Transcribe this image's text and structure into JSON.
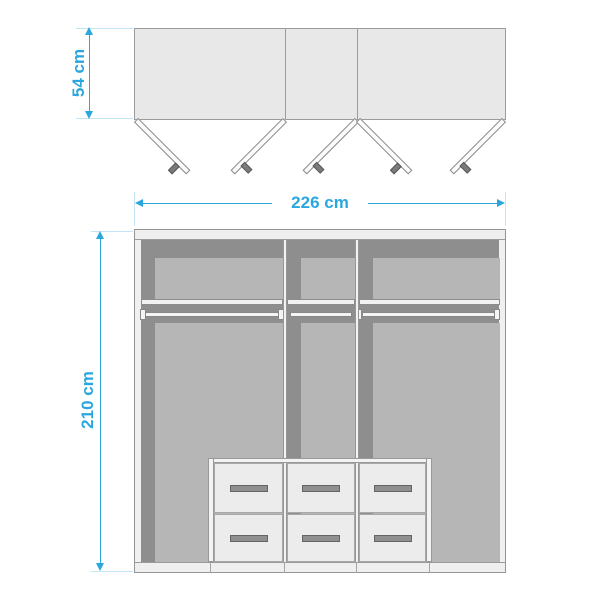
{
  "diagram": {
    "subject": "wardrobe-dimension-diagram",
    "accent_color": "#2ba7df",
    "extension_line_color": "#c3e5f6",
    "body_fill_color": "#e8e8e8",
    "interior_dark_color": "#8e8e8e",
    "interior_light_color": "#b6b6b6",
    "dimensions": {
      "depth_label": "54 cm",
      "width_label": "226 cm",
      "height_label": "210 cm",
      "depth_cm": 54,
      "width_cm": 226,
      "height_cm": 210
    },
    "features": {
      "sections": 3,
      "doors": 5,
      "drawers": 6,
      "shelves": 3,
      "hanging_rails": 3
    }
  }
}
